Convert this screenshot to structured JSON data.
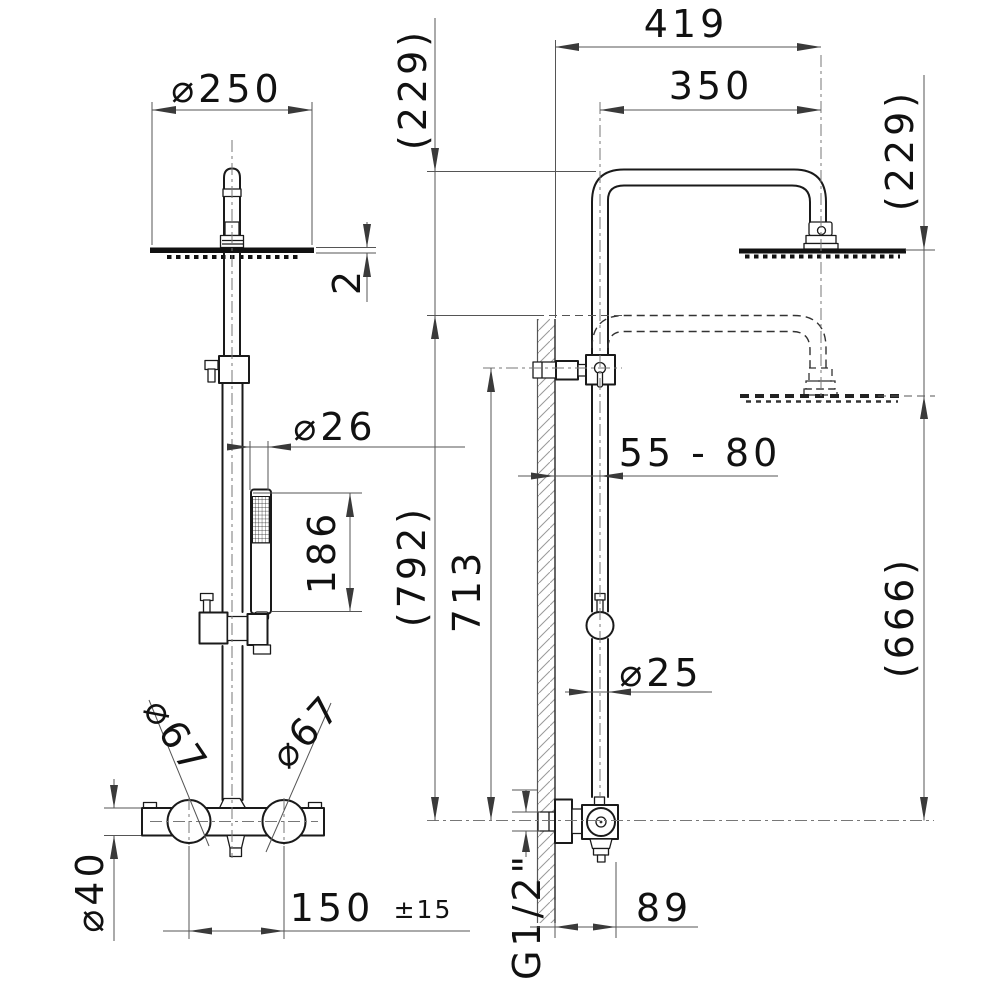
{
  "drawing": {
    "type": "technical-dimension-drawing",
    "subject": "thermostatic shower column, front and side views",
    "colors": {
      "line": "#1a1a1a",
      "dimension": "#555555",
      "background": "#ffffff"
    }
  },
  "labels": {
    "dia250": "⌀250",
    "thickness2": "2",
    "dia26": "⌀26",
    "len186": "186",
    "dia67_left": "⌀67",
    "dia67_right": "⌀67",
    "dia40": "⌀40",
    "len150": "150",
    "tol150": "±15",
    "len419": "419",
    "len350": "350",
    "drop229_front": "(229)",
    "drop229_side": "(229)",
    "range_wall": "55 - 80",
    "h792": "(792)",
    "h713": "713",
    "h666": "(666)",
    "dia25": "⌀25",
    "thread": "G1/2\"",
    "len89": "89"
  }
}
